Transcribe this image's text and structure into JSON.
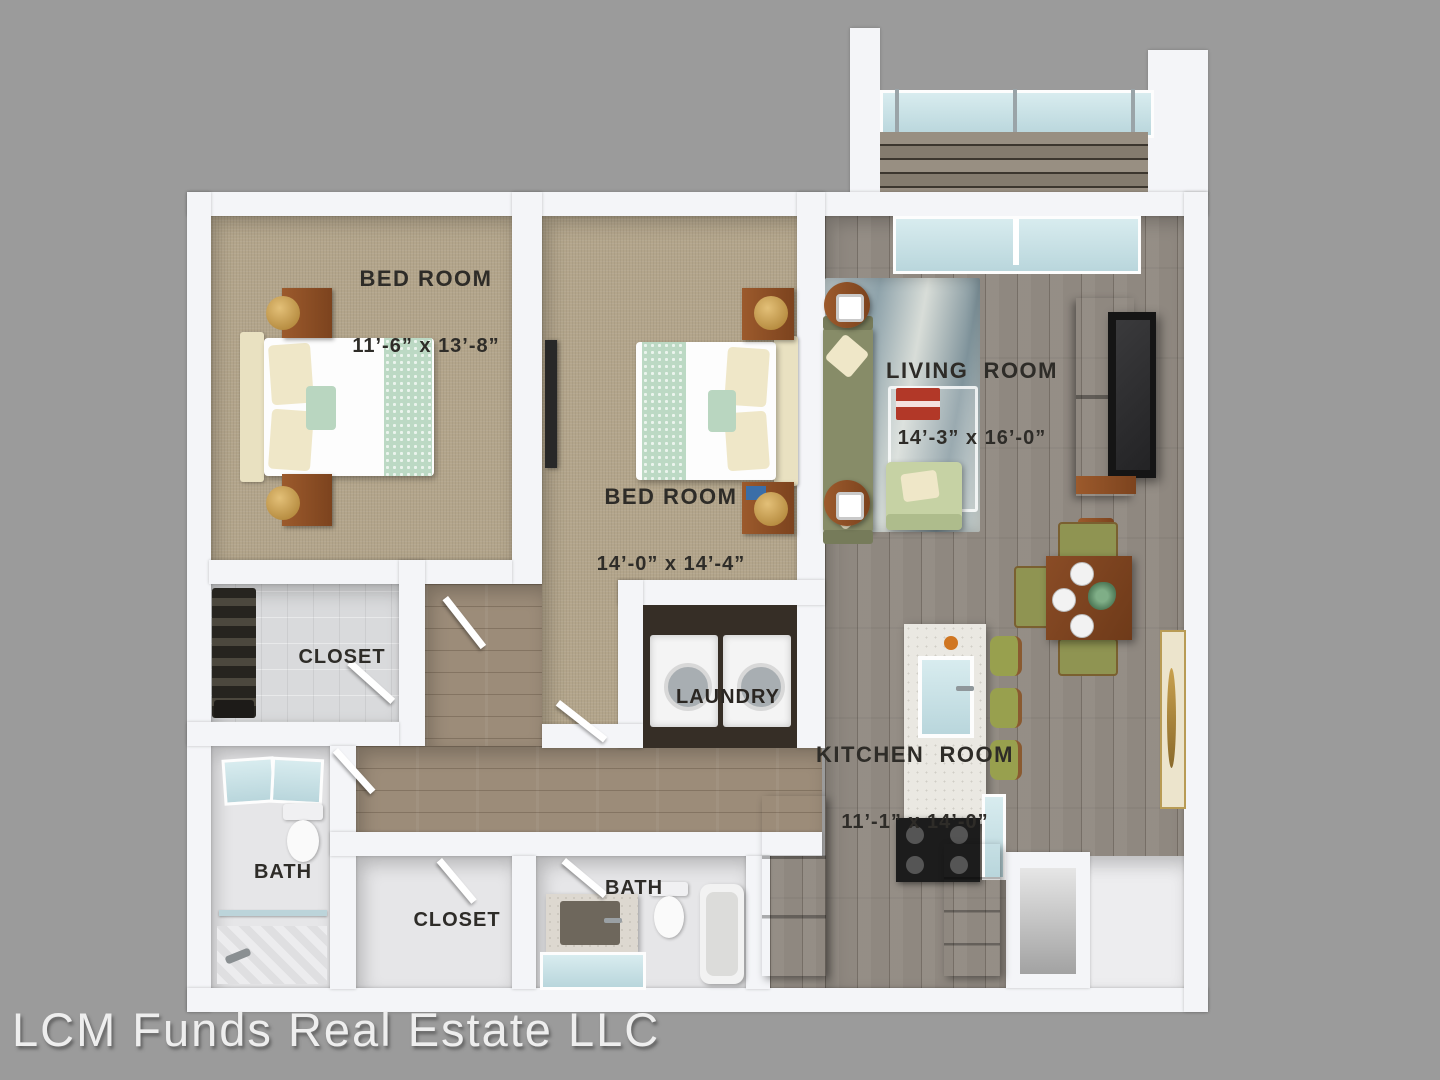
{
  "watermark": "LCM Funds Real Estate LLC",
  "rooms": {
    "bedroom1": {
      "name": "BED ROOM",
      "dims": "11’-6” x 13’-8”"
    },
    "bedroom2": {
      "name": "BED ROOM",
      "dims": "14’-0” x 14’-4”"
    },
    "living_room": {
      "name": "LIVING  ROOM",
      "dims": "14’-3” x 16’-0”"
    },
    "kitchen": {
      "name": "KITCHEN  ROOM",
      "dims": "11’-1” x 14’-0”"
    },
    "laundry": {
      "name": "LAUNDRY"
    },
    "closet_top": {
      "name": "CLOSET"
    },
    "closet_bottom": {
      "name": "CLOSET"
    },
    "bath_left": {
      "name": "BATH"
    },
    "bath_middle": {
      "name": "BATH"
    }
  },
  "colors": {
    "background": "#9b9b9b",
    "wall": "#f4f5f8",
    "carpet": "#b3a58b",
    "wood_gray_floor": "#8f8880",
    "wood_warm_floor": "#9c8c79",
    "furniture_wood": "#8a5530",
    "sofa_green": "#878c68",
    "bed_runner_green": "#bcd9c4",
    "glass_blue": "#cfe4ea",
    "label_text": "#2e2c28"
  }
}
